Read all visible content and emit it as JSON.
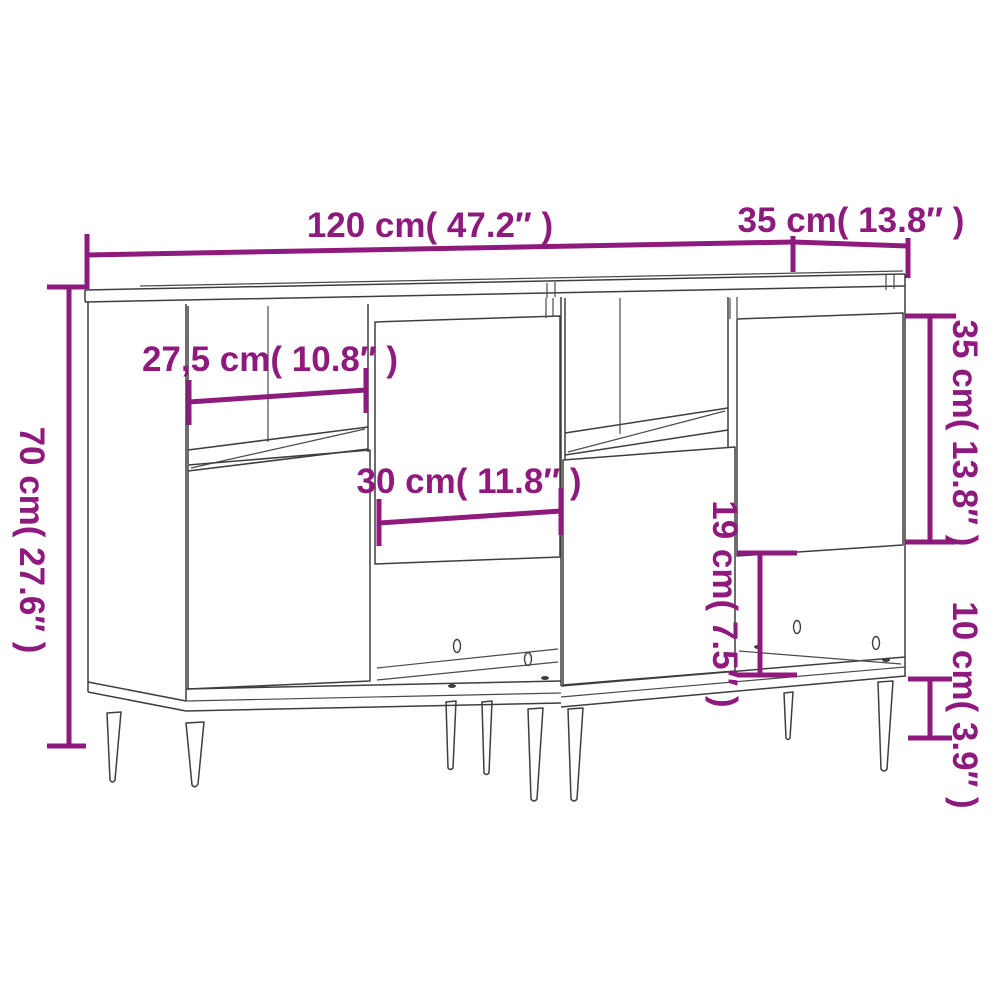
{
  "diagram_type": "furniture-dimension-diagram",
  "subject": "two sideboards side by side, line drawing with dimension callouts",
  "colors": {
    "dimension_accent": "#8e1a7d",
    "outline": "#3e3e3e",
    "background": "#ffffff"
  },
  "measurements": [
    {
      "id": "total-width",
      "cm": "120",
      "inches": "47.2",
      "orientation": "horizontal",
      "label": "120 cm( 47.2″ )"
    },
    {
      "id": "depth",
      "cm": "35",
      "inches": "13.8",
      "orientation": "horizontal",
      "label": "35 cm( 13.8″ )"
    },
    {
      "id": "total-height",
      "cm": "70",
      "inches": "27.6",
      "orientation": "vertical",
      "label": "70 cm( 27.6″ )"
    },
    {
      "id": "shelf-width",
      "cm": "27,5",
      "inches": "10.8",
      "orientation": "horizontal",
      "label": "27,5 cm( 10.8″ )"
    },
    {
      "id": "door-width",
      "cm": "30",
      "inches": "11.8",
      "orientation": "horizontal",
      "label": "30 cm( 11.8″ )"
    },
    {
      "id": "open-compartment-height",
      "cm": "19",
      "inches": "7.5",
      "orientation": "vertical",
      "label": "19 cm( 7.5″ )"
    },
    {
      "id": "door-height",
      "cm": "35",
      "inches": "13.8",
      "orientation": "vertical",
      "label": "35 cm( 13.8″ )"
    },
    {
      "id": "leg-height",
      "cm": "10",
      "inches": "3.9",
      "orientation": "vertical",
      "label": "10 cm( 3.9″ )"
    }
  ]
}
